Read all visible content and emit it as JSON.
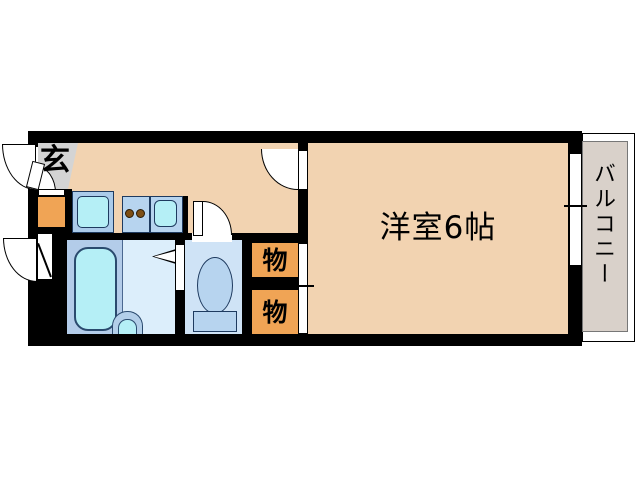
{
  "floorplan": {
    "entrance": {
      "label": "玄"
    },
    "main_room": {
      "label": "洋室6帖"
    },
    "balcony": {
      "label": "バルコニー"
    },
    "storage_top": {
      "label": "物"
    },
    "storage_bottom": {
      "label": "物"
    },
    "colors": {
      "wall": "#000000",
      "floor": "#f2d3b1",
      "entrance_floor": "#d4d4d4",
      "storage_orange": "#f0a455",
      "fixture_cyan": "#b5eff6",
      "fixture_blue": "#b7d4ef",
      "unit_frame_blue": "#abcbea",
      "bath_floor": "#b3cce9",
      "washroom_floor": "#dceefb",
      "toilet_floor": "#cfe3f6",
      "balcony_floor": "#d9d1ca",
      "burner_brown": "#7d4e14",
      "fixture_outline": "#1e3a5f"
    }
  }
}
